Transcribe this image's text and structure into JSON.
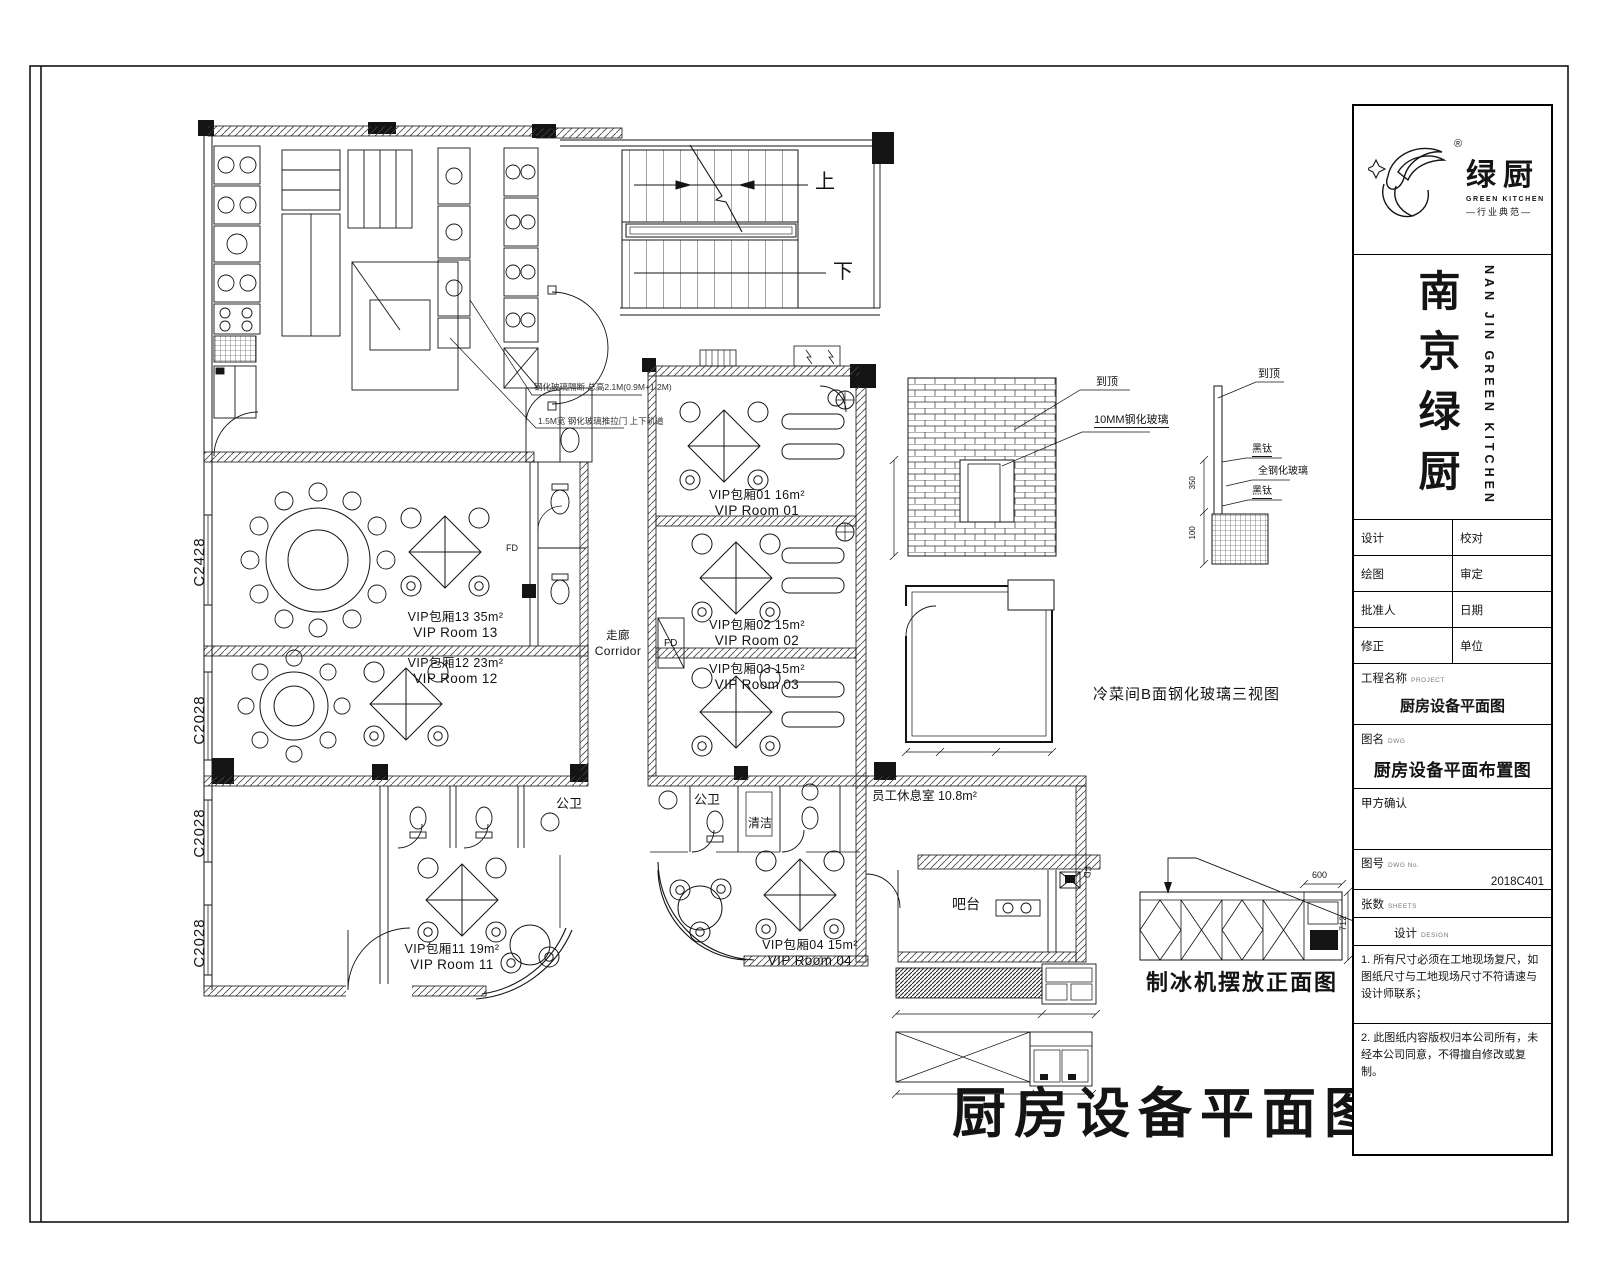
{
  "page": {
    "bg": "#ffffff",
    "ink": "#141414"
  },
  "titleblock": {
    "reg": "®",
    "brand_cn": "绿厨",
    "brand_en": "GREEN KITCHEN",
    "slogan": "—行业典范—",
    "company_cn": "南京绿厨",
    "company_en": "NAN JIN GREEN KITCHEN",
    "rows": [
      {
        "l": "设计",
        "r": "校对"
      },
      {
        "l": "绘图",
        "r": "审定"
      },
      {
        "l": "批准人",
        "r": "日期"
      },
      {
        "l": "修正",
        "r": "单位"
      }
    ],
    "project_label": "工程名称",
    "project_sub": "PROJECT",
    "project_value": "厨房设备平面图",
    "dwg_label": "图名",
    "dwg_sub": "DWG",
    "dwg_value": "厨房设备平面布置图",
    "client_label": "甲方确认",
    "no_label": "图号",
    "no_sub": "DWG No.",
    "no_value": "2018C401",
    "sheets_label": "张数",
    "sheets_sub": "SHEETS",
    "design_label": "设计",
    "design_sub": "DESIGN",
    "note1": "1. 所有尺寸必须在工地现场复尺，如图纸尺寸与工地现场尺寸不符请速与设计师联系；",
    "note2": "2. 此图纸内容版权归本公司所有，未经本公司同意，不得擅自修改或复制。"
  },
  "plan": {
    "main_title": "厨房设备平面图",
    "stairs_up": "上",
    "stairs_down": "下",
    "corridor_cn": "走廊",
    "corridor_en": "Corridor",
    "rooms": {
      "vip13": {
        "cn": "VIP包厢13  35m²",
        "en": "VIP Room 13"
      },
      "vip12": {
        "cn": "VIP包厢12  23m²",
        "en": "VIP Room 12"
      },
      "vip11": {
        "cn": "VIP包厢11  19m²",
        "en": "VIP Room 11"
      },
      "vip01": {
        "cn": "VIP包厢01  16m²",
        "en": "VIP Room 01"
      },
      "vip02": {
        "cn": "VIP包厢02  15m²",
        "en": "VIP Room 02"
      },
      "vip03": {
        "cn": "VIP包厢03  15m²",
        "en": "VIP Room 03"
      },
      "vip04": {
        "cn": "VIP包厢04  15m²",
        "en": "VIP Room 04"
      }
    },
    "wc": "公卫",
    "cleaning": "清洁",
    "staff_room": "员工休息室 10.8m²",
    "bar": "吧台",
    "fd": "FD",
    "windows": [
      "C2428",
      "C2028",
      "C2028",
      "C2028"
    ],
    "views": {
      "cold_room": "冷菜间B面钢化玻璃三视图",
      "ice_front": "制冰机摆放正面图",
      "ice_pointer": "制冰机"
    },
    "leaders": {
      "to_ceiling": "到顶",
      "glass": "10MM钢化玻璃",
      "black_ti": "黑钛",
      "steel_glass": "全钢化玻璃"
    },
    "dims": {
      "d600": "600",
      "d712": "712",
      "d350": "350",
      "d100": "100"
    },
    "kitchen_note1": "钢化玻璃隔断 总高2.1M(0.9M+1.2M)",
    "kitchen_note2": "1.5M宽 钢化玻璃推拉门 上下轨道"
  }
}
